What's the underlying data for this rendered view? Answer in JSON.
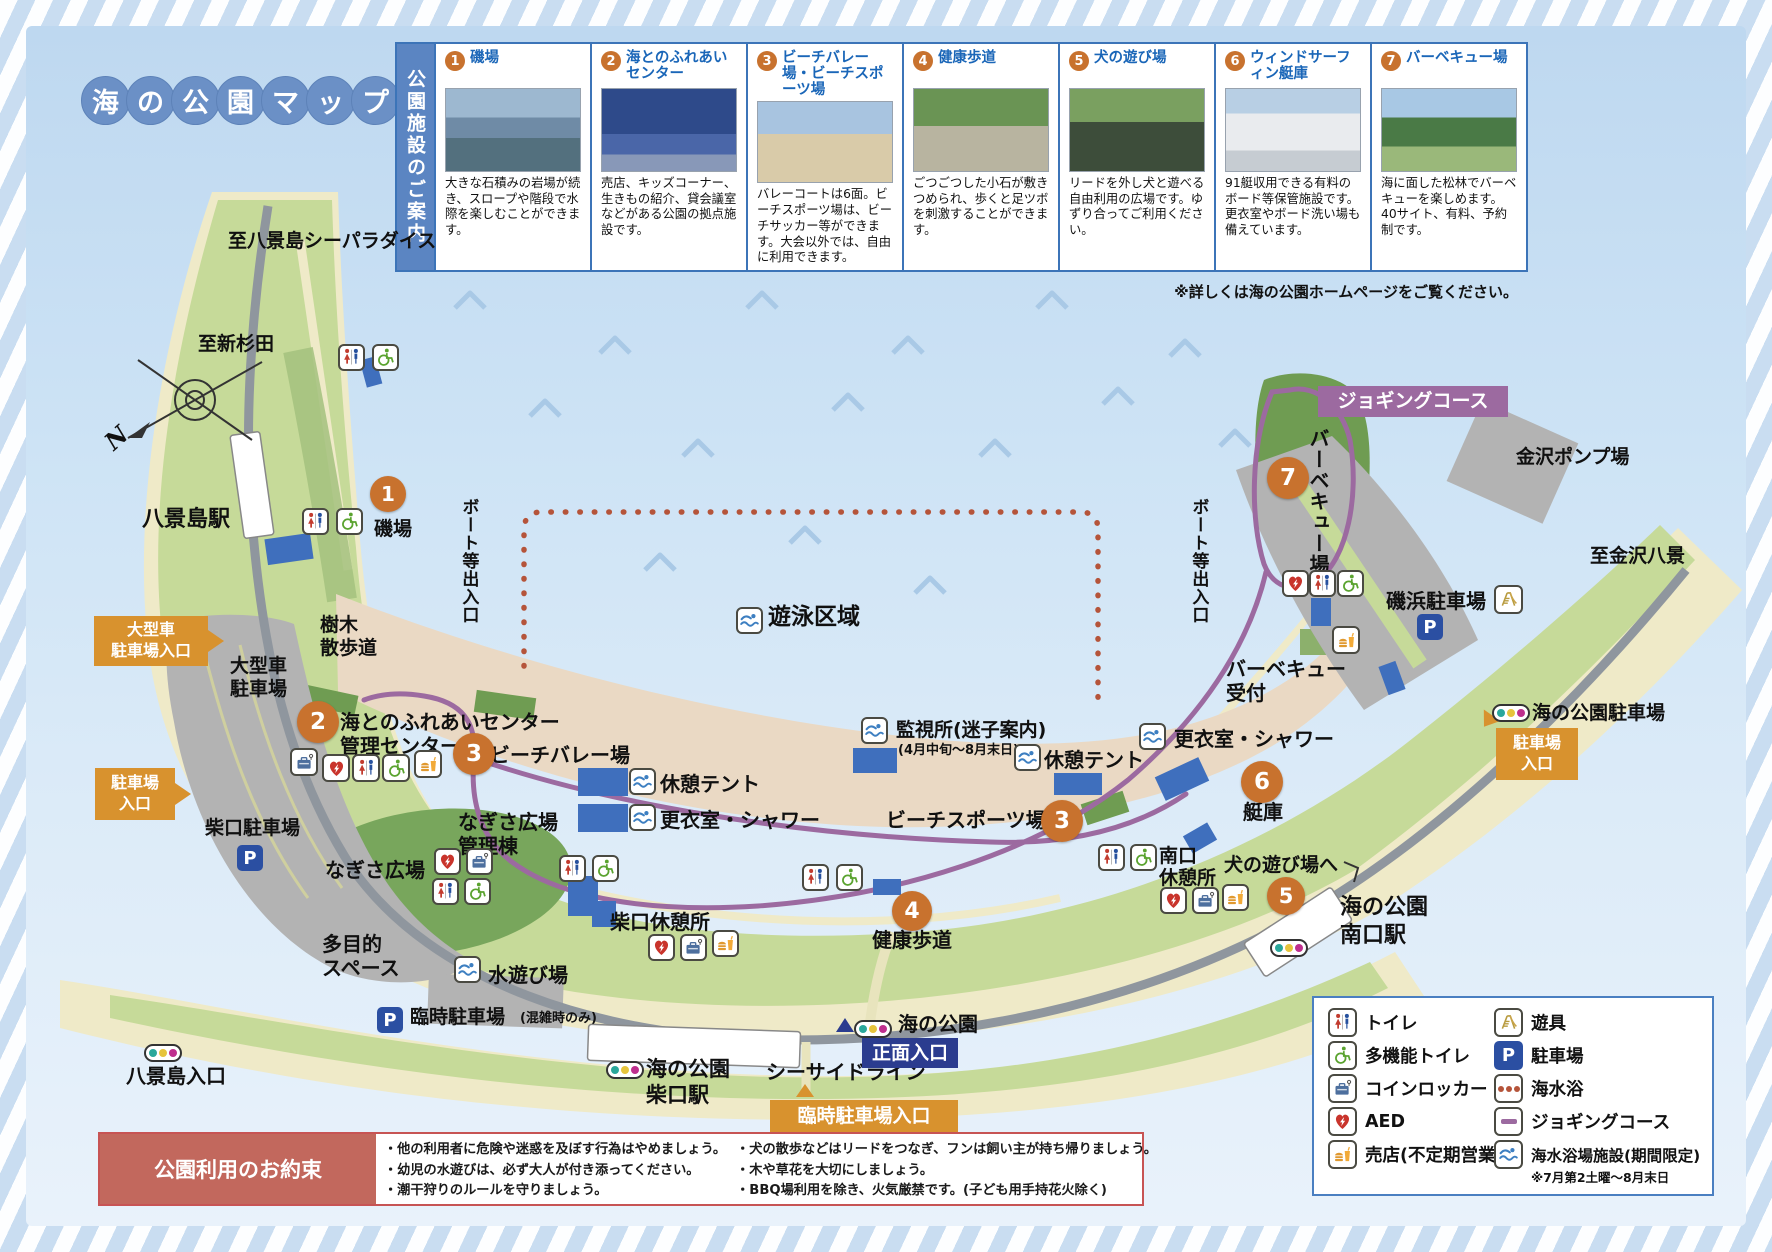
{
  "title": {
    "chars": [
      "海",
      "の",
      "公",
      "園",
      "マ",
      "ッ",
      "プ"
    ]
  },
  "facilities": {
    "header": "公園施設のご案内",
    "note": "※詳しくは海の公園ホームページをご覧ください。",
    "cards": [
      {
        "num": "1",
        "title": "磯場",
        "desc": "大きな石積みの岩場が続き、スロープや階段で水際を楽しむことができます。"
      },
      {
        "num": "2",
        "title": "海とのふれあいセンター",
        "desc": "売店、キッズコーナー、生きもの紹介、貸会議室などがある公園の拠点施設です。"
      },
      {
        "num": "3",
        "title": "ビーチバレー場・ビーチスポーツ場",
        "desc": "バレーコートは6面。ビーチスポーツ場は、ビーチサッカー等ができます。大会以外では、自由に利用できます。"
      },
      {
        "num": "4",
        "title": "健康歩道",
        "desc": "ごつごつした小石が敷きつめられ、歩くと足ツボを刺激することができます。"
      },
      {
        "num": "5",
        "title": "犬の遊び場",
        "desc": "リードを外し犬と遊べる自由利用の広場です。ゆずり合ってご利用ください。"
      },
      {
        "num": "6",
        "title": "ウィンドサーフィン艇庫",
        "desc": "91艇収用できる有料のボード等保管施設です。更衣室やボード洗い場も備えています。"
      },
      {
        "num": "7",
        "title": "バーベキュー場",
        "desc": "海に面した松林でバーベキューを楽しめます。40サイト、有料、予約制です。"
      }
    ]
  },
  "map": {
    "n1": "1",
    "n2": "2",
    "n3": "3",
    "n4": "4",
    "n5": "5",
    "n6": "6",
    "n7": "7",
    "compass_n": "N",
    "dir_seaparadise": "至八景島シーパラダイス",
    "dir_shinsugita": "至新杉田",
    "sta_hakkeijima": "八景島駅",
    "badge_large_parking": "大型車\n駐車場入口",
    "lot_large": "大型車\n駐車場",
    "trees": "樹木\n散歩道",
    "badge_parking_left": "駐車場\n入口",
    "lot_shibaguchi": "柴口駐車場",
    "boat_gate_left": "ボート等出入口",
    "isoba": "磯場",
    "fureai": "海とのふれあいセンター\n管理センター",
    "beach_volley": "ビーチバレー場",
    "nagisa_kanri": "なぎさ広場\n管理棟",
    "nagisa": "なぎさ広場",
    "tamokuteki": "多目的\nスペース",
    "mizuasobi": "水遊び場",
    "shibaguchi_rest": "柴口休憩所",
    "tent_left": "休憩テント",
    "shower_left": "更衣室・シャワー",
    "swim_zone": "遊泳区域",
    "monitor": "監視所(迷子案内)",
    "monitor_sub": "(4月中旬～8月末日)",
    "tent_mid": "休憩テント",
    "beach_sports": "ビーチスポーツ場",
    "kenko": "健康歩道",
    "shower_right": "更衣室・シャワー",
    "minamiguchi_rest": "南口\n休憩所",
    "dog_area": "犬の遊び場へ",
    "sta_minamiguchi": "海の公園\n南口駅",
    "teiko": "艇庫",
    "bbq_reception": "バーベキュー\n受付",
    "bbq_area_vertical": "バーベキュー場",
    "jogging_course": "ジョギングコース",
    "boat_gate_right": "ボート等出入口",
    "lot_isohama": "磯浜駐車場",
    "kanazawa_pump": "金沢ポンプ場",
    "dir_kanazawa_hakkei": "至金沢八景",
    "lot_uminokoen": "海の公園駐車場",
    "badge_parking_right": "駐車場\n入口",
    "rinji_parking": "臨時駐車場",
    "rinji_parking_sub": "(混雑時のみ)",
    "hakkeijima_gate": "八景島入口",
    "sta_shibaguchi_full": "海の公園\n柴口駅",
    "seaside_line": "シーサイドライン",
    "badge_rinji_entrance": "臨時駐車場入口",
    "main_gate": "正面入口",
    "umi_no_koen_gate": "海の公園",
    "p_letter": "P"
  },
  "legend": {
    "left": [
      {
        "label": "トイレ"
      },
      {
        "label": "多機能トイレ"
      },
      {
        "label": "コインロッカー"
      },
      {
        "label": "AED"
      },
      {
        "label": "売店(不定期営業)"
      }
    ],
    "right": [
      {
        "label": "遊具"
      },
      {
        "label": "駐車場"
      },
      {
        "label": "海水浴"
      },
      {
        "label": "ジョギングコース"
      },
      {
        "label": "海水浴場施設(期間限定)"
      }
    ],
    "seasonal_note": "※7月第2土曜～8月末日"
  },
  "rules": {
    "title": "公園利用のお約束",
    "col1": [
      "・他の利用者に危険や迷惑を及ぼす行為はやめましょう。",
      "・幼児の水遊びは、必ず大人が付き添ってください。",
      "・潮干狩りのルールを守りましょう。"
    ],
    "col2": [
      "・犬の散歩などはリードをつなぎ、フンは飼い主が持ち帰りましょう。",
      "・木や草花を大切にしましょう。",
      "・BBQ場利用を除き、火気厳禁です。(子ども用手持花火除く)"
    ]
  },
  "colors": {
    "accent_orange": "#c8722e",
    "badge_orange": "#d8922e",
    "card_title_blue": "#1a66b8",
    "jogging_purple": "#9c6aa0",
    "legend_border_blue": "#4a7fc1",
    "rules_red": "#c2685d",
    "navy": "#2b3c8f"
  }
}
